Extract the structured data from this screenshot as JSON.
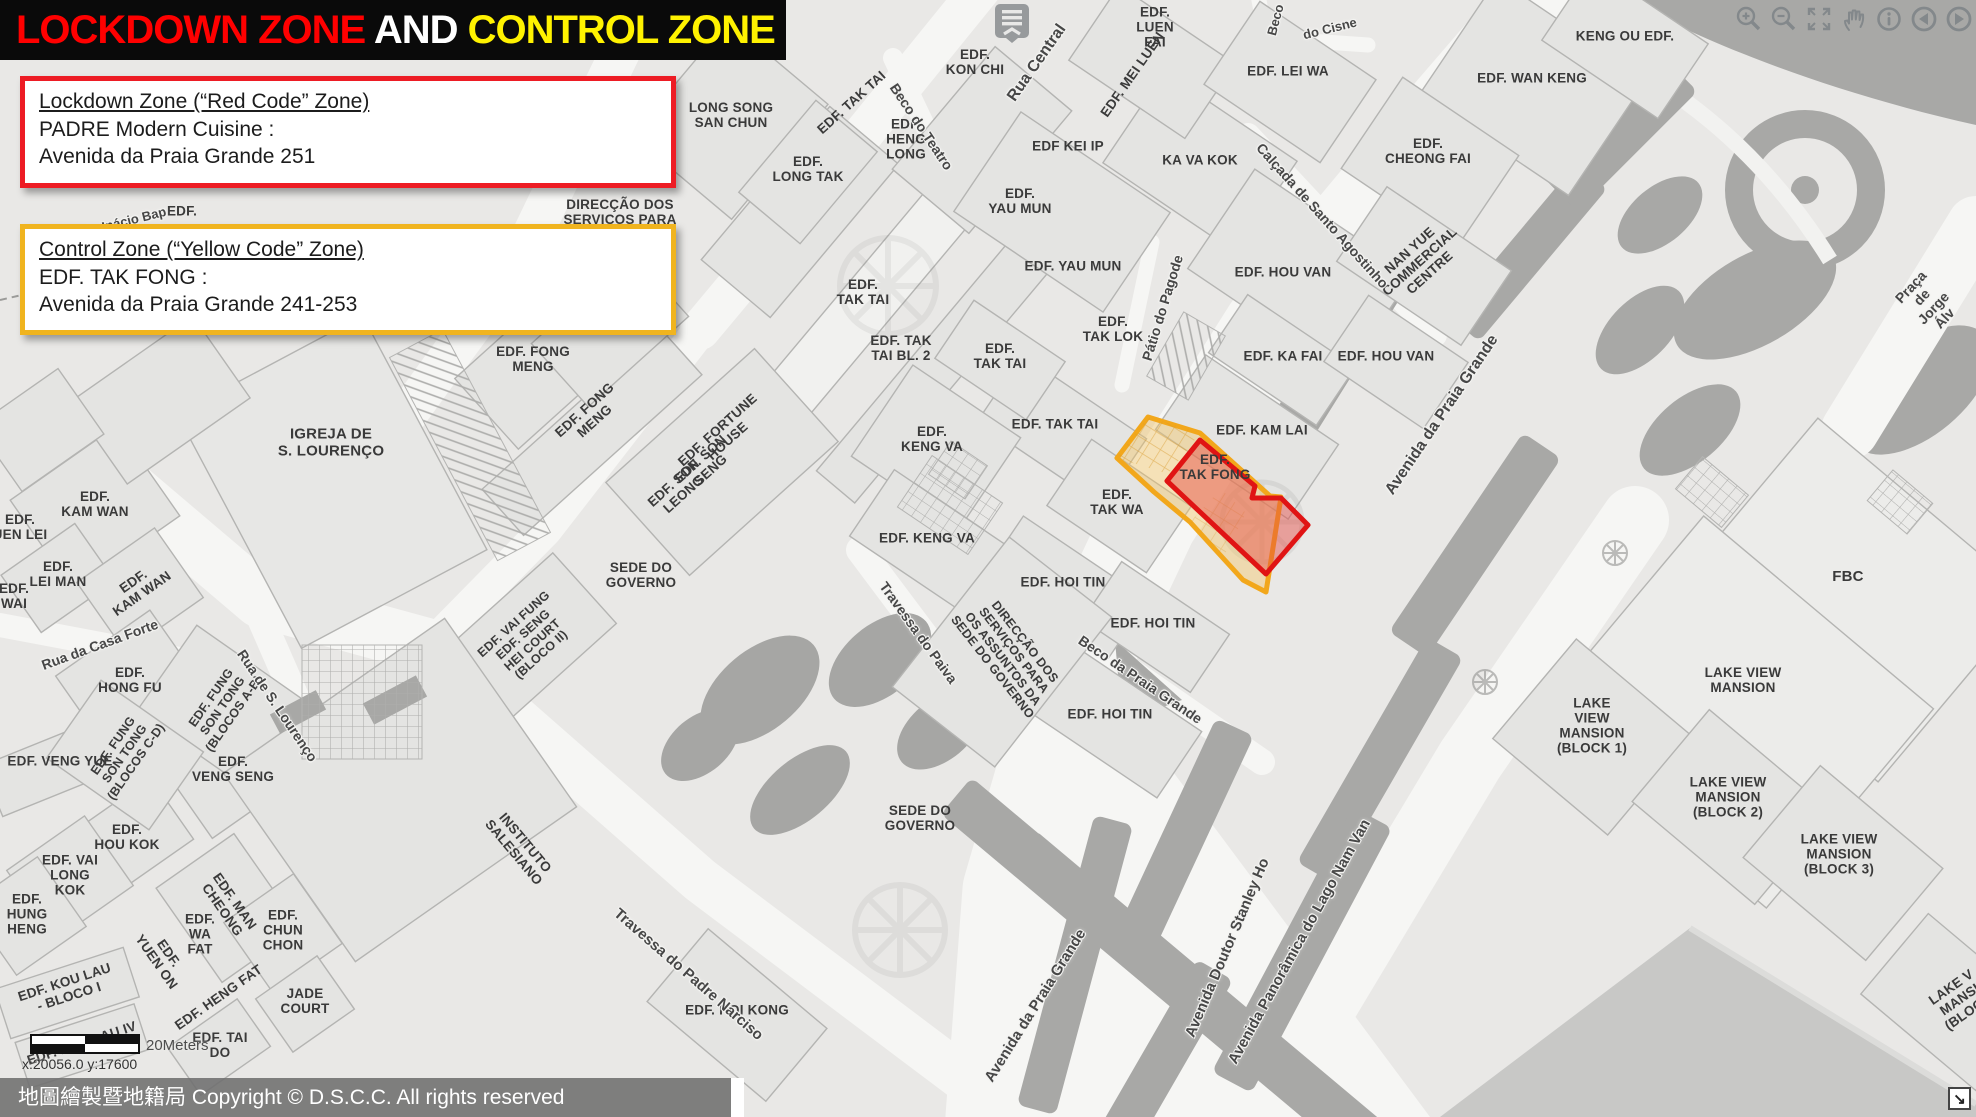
{
  "title_banner": {
    "lockdown_text": "LOCKDOWN ZONE",
    "and_text": " AND ",
    "control_text": "CONTROL ZONE",
    "lockdown_color": "#FF0000",
    "and_color": "#FFFFFF",
    "control_color": "#FFF200",
    "background": "#0A0A0A"
  },
  "legend": {
    "lockdown": {
      "heading": "Lockdown Zone (“Red Code” Zone)",
      "line2": "PADRE Modern Cuisine :",
      "line3": "Avenida da Praia Grande 251",
      "border_color": "#ED1C24"
    },
    "control": {
      "heading": "Control Zone (“Yellow Code” Zone)",
      "line2": "EDF. TAK FONG :",
      "line3": "Avenida da Praia Grande 241-253",
      "border_color": "#F0B41F"
    }
  },
  "toolbar": {
    "icons": [
      "zoom-in",
      "zoom-out",
      "full-extent",
      "pan",
      "identify",
      "previous-view",
      "next-view"
    ]
  },
  "zones": {
    "control": {
      "name": "Control Zone",
      "border": "#F2A71B",
      "fill": "rgba(244,196,92,0.40)"
    },
    "lockdown": {
      "name": "Lockdown Zone",
      "border": "#E01414",
      "fill": "rgba(229,72,65,0.45)"
    }
  },
  "scale_bar": {
    "label": "20Meters"
  },
  "status": {
    "coordinates": "x:20056.0  y:17600"
  },
  "attribution": {
    "text": "地圖繪製暨地籍局 Copyright © D.S.C.C. All rights reserved"
  },
  "map": {
    "labels": [
      {
        "t": "LONG SONG\nSAN CHUN",
        "x": 731,
        "y": 116
      },
      {
        "t": "EDF. TAK TAI",
        "x": 852,
        "y": 103,
        "r": -42
      },
      {
        "t": "EDF.\nHENG\nLONG",
        "x": 906,
        "y": 140
      },
      {
        "t": "EDF.\nKON CHI",
        "x": 975,
        "y": 63
      },
      {
        "t": "EDF.\nLONG TAK",
        "x": 808,
        "y": 170
      },
      {
        "t": "EDF.\nLUEN\nFAI",
        "x": 1155,
        "y": 28
      },
      {
        "t": "EDF. MEI LUEN",
        "x": 1133,
        "y": 75,
        "r": -55
      },
      {
        "t": "EDF. LEI WA",
        "x": 1288,
        "y": 72
      },
      {
        "t": "KENG OU EDF.",
        "x": 1625,
        "y": 37
      },
      {
        "t": "EDF. WAN KENG",
        "x": 1532,
        "y": 79
      },
      {
        "t": "EDF.\nCHEONG FAI",
        "x": 1428,
        "y": 152
      },
      {
        "t": "NAN YUE\nCOMMERCIAL\nCENTRE",
        "x": 1420,
        "y": 262,
        "r": -42
      },
      {
        "t": "EDF KEI IP",
        "x": 1068,
        "y": 147
      },
      {
        "t": "KA VA KOK",
        "x": 1200,
        "y": 161
      },
      {
        "t": "EDF.\nYAU MUN",
        "x": 1020,
        "y": 202
      },
      {
        "t": "EDF. YAU MUN",
        "x": 1073,
        "y": 267
      },
      {
        "t": "EDF. HOU VAN",
        "x": 1283,
        "y": 273
      },
      {
        "t": "EDF.\nTAK LOK",
        "x": 1113,
        "y": 330
      },
      {
        "t": "EDF. KA FAI",
        "x": 1283,
        "y": 357
      },
      {
        "t": "EDF. HOU VAN",
        "x": 1386,
        "y": 357
      },
      {
        "t": "EDF.\nTAK TAI",
        "x": 863,
        "y": 293
      },
      {
        "t": "EDF. TAK\nTAI BL. 2",
        "x": 901,
        "y": 349
      },
      {
        "t": "EDF.\nTAK TAI",
        "x": 1000,
        "y": 357
      },
      {
        "t": "EDF. TAK TAI",
        "x": 1055,
        "y": 425
      },
      {
        "t": "EDF. KAM LAI",
        "x": 1262,
        "y": 431
      },
      {
        "t": "EDF.\nTAK FONG",
        "x": 1215,
        "y": 468
      },
      {
        "t": "EDF.\nTAK WA",
        "x": 1117,
        "y": 503
      },
      {
        "t": "EDF.\nKENG VA",
        "x": 932,
        "y": 440
      },
      {
        "t": "EDF. KENG VA",
        "x": 927,
        "y": 539
      },
      {
        "t": "EDF. HOI TIN",
        "x": 1063,
        "y": 583
      },
      {
        "t": "EDF. HOI TIN",
        "x": 1153,
        "y": 624
      },
      {
        "t": "EDF. HOI TIN",
        "x": 1110,
        "y": 715
      },
      {
        "t": "EDF. FONG\nMENG",
        "x": 533,
        "y": 360
      },
      {
        "t": "EDF. FONG\nMENG",
        "x": 590,
        "y": 416,
        "r": -42
      },
      {
        "t": "EDF. FORTUNE\nHOUSE",
        "x": 723,
        "y": 436,
        "r": -42
      },
      {
        "t": "EDF. SON\nSENG",
        "x": 706,
        "y": 465,
        "r": -42
      },
      {
        "t": "EDF. SON\nLEONG",
        "x": 679,
        "y": 489,
        "r": -42
      },
      {
        "t": "IGREJA DE\nS. LOURENÇO",
        "x": 331,
        "y": 443,
        "s": 15
      },
      {
        "t": "EDF.\nKAM WAN",
        "x": 95,
        "y": 505
      },
      {
        "t": "EDF.\nUEN LEI",
        "x": 20,
        "y": 528
      },
      {
        "t": "EDF.\nLEI MAN",
        "x": 58,
        "y": 575
      },
      {
        "t": "EDF.\nKAM WAN",
        "x": 138,
        "y": 588,
        "r": -35
      },
      {
        "t": "EDF.\nWAI",
        "x": 14,
        "y": 597
      },
      {
        "t": "EDF.\nHONG FU",
        "x": 130,
        "y": 681
      },
      {
        "t": "EDF. FUNG\nSON TONG\n(BLOCOS A-B)",
        "x": 223,
        "y": 706,
        "r": -55,
        "s": 12.5
      },
      {
        "t": "EDF. VENG YUE",
        "x": 60,
        "y": 762
      },
      {
        "t": "EDF. FUNG\nSON TONG\n(BLOCOS C-D)",
        "x": 125,
        "y": 754,
        "r": -55,
        "s": 12.5
      },
      {
        "t": "EDF.\nVENG SENG",
        "x": 233,
        "y": 770
      },
      {
        "t": "EDF.\nHOU KOK",
        "x": 127,
        "y": 838
      },
      {
        "t": "EDF. VAI\nLONG\nKOK",
        "x": 70,
        "y": 876
      },
      {
        "t": "EDF.\nHUNG\nHENG",
        "x": 27,
        "y": 915
      },
      {
        "t": "EDF. MAN\nCHEONG",
        "x": 228,
        "y": 906,
        "r": 55
      },
      {
        "t": "EDF.\nWA\nFAT",
        "x": 200,
        "y": 935
      },
      {
        "t": "EDF.\nYUEN ON",
        "x": 162,
        "y": 958,
        "r": 55
      },
      {
        "t": "EDF.\nCHUN\nCHON",
        "x": 283,
        "y": 931
      },
      {
        "t": "EDF. KOU LAU\n- BLOCO I",
        "x": 67,
        "y": 990,
        "r": -18
      },
      {
        "t": "EDF. HENG FAT",
        "x": 219,
        "y": 998,
        "r": -35
      },
      {
        "t": "JADE\nCOURT",
        "x": 305,
        "y": 1002
      },
      {
        "t": "EDF. TAI\nDO",
        "x": 220,
        "y": 1046
      },
      {
        "t": "EDF. KOU LAU IV",
        "x": 82,
        "y": 1044,
        "r": -18
      },
      {
        "t": "SEDE DO\nGOVERNO",
        "x": 641,
        "y": 576
      },
      {
        "t": "SEDE DO\nGOVERNO",
        "x": 920,
        "y": 819
      },
      {
        "t": "INSTITUTO\nSALESIANO",
        "x": 519,
        "y": 848,
        "r": 50
      },
      {
        "t": "DIRECÇÃO DOS\nSERVIÇOS PARA",
        "x": 620,
        "y": 213
      },
      {
        "t": "DIRECÇÃO DOS\nSERVIÇOS PARA\nOS ASSUNTOS DA\nSEDE DO GOVERNO",
        "x": 1008,
        "y": 655,
        "r": 52,
        "s": 12.5
      },
      {
        "t": "EDF. HOI KONG",
        "x": 737,
        "y": 1011
      },
      {
        "t": "FBC",
        "x": 1848,
        "y": 577,
        "s": 15
      },
      {
        "t": "LAKE VIEW\nMANSION",
        "x": 1743,
        "y": 681
      },
      {
        "t": "LAKE\nVIEW\nMANSION\n(BLOCK 1)",
        "x": 1592,
        "y": 726
      },
      {
        "t": "LAKE VIEW\nMANSION\n(BLOCK 2)",
        "x": 1728,
        "y": 798
      },
      {
        "t": "LAKE VIEW\nMANSION\n(BLOCK 3)",
        "x": 1839,
        "y": 855
      },
      {
        "t": "LAKE V\nMANSI\n(BLOCK",
        "x": 1960,
        "y": 1000,
        "r": -35
      },
      {
        "t": "EDF. VAI FUNG\nEDF. SENG\nHEI COURT\n(BLOCO II)",
        "x": 528,
        "y": 640,
        "r": -42,
        "s": 12.5
      },
      {
        "t": "EDF.",
        "x": 182,
        "y": 212
      },
      {
        "t": "Rua Central",
        "x": 1037,
        "y": 63,
        "r": -55,
        "s": 16,
        "halo": true
      },
      {
        "t": "Beco do Teatro",
        "x": 921,
        "y": 127,
        "r": 56,
        "s": 14,
        "halo": true
      },
      {
        "t": "Calçada de Santo Agostinho",
        "x": 1322,
        "y": 216,
        "r": 48,
        "s": 14,
        "halo": true
      },
      {
        "t": "Beco",
        "x": 1276,
        "y": 20,
        "r": -75,
        "s": 13,
        "halo": true
      },
      {
        "t": "do Cisne",
        "x": 1330,
        "y": 29,
        "r": -14,
        "s": 13,
        "halo": true
      },
      {
        "t": "Pátio do Pagode",
        "x": 1163,
        "y": 308,
        "r": -73,
        "s": 14,
        "halo": true
      },
      {
        "t": "Travessa do Paiva",
        "x": 918,
        "y": 633,
        "r": 54,
        "s": 14,
        "halo": true
      },
      {
        "t": "Travessa do Padre Narciso",
        "x": 688,
        "y": 975,
        "r": 41,
        "s": 15,
        "halo": true
      },
      {
        "t": "Beco da Praia Grande",
        "x": 1140,
        "y": 680,
        "r": 34,
        "s": 14,
        "halo": true
      },
      {
        "t": "Avenida da Praia Grande",
        "x": 1442,
        "y": 415,
        "r": -56,
        "s": 16,
        "halo": true
      },
      {
        "t": "Avenida da Praia Grande",
        "x": 1036,
        "y": 1006,
        "r": -58,
        "s": 15,
        "halo": true
      },
      {
        "t": "Avenida Doutor Stanley Ho",
        "x": 1228,
        "y": 948,
        "r": -67,
        "s": 15,
        "halo": true
      },
      {
        "t": "Avenida Panorâmica do Lago Nam Van",
        "x": 1300,
        "y": 942,
        "r": -61,
        "s": 15,
        "halo": true
      },
      {
        "t": "Rua da Casa Forte",
        "x": 100,
        "y": 645,
        "r": -20,
        "s": 14,
        "halo": true
      },
      {
        "t": "Rua de S. Lourenço",
        "x": 277,
        "y": 706,
        "r": 56,
        "s": 14,
        "halo": true
      },
      {
        "t": "de Inácio Bap",
        "x": 125,
        "y": 222,
        "r": -14,
        "s": 13,
        "halo": true
      },
      {
        "t": "Praça de Jorge Álv",
        "x": 1928,
        "y": 303,
        "r": -47,
        "s": 14,
        "halo": true
      }
    ]
  }
}
